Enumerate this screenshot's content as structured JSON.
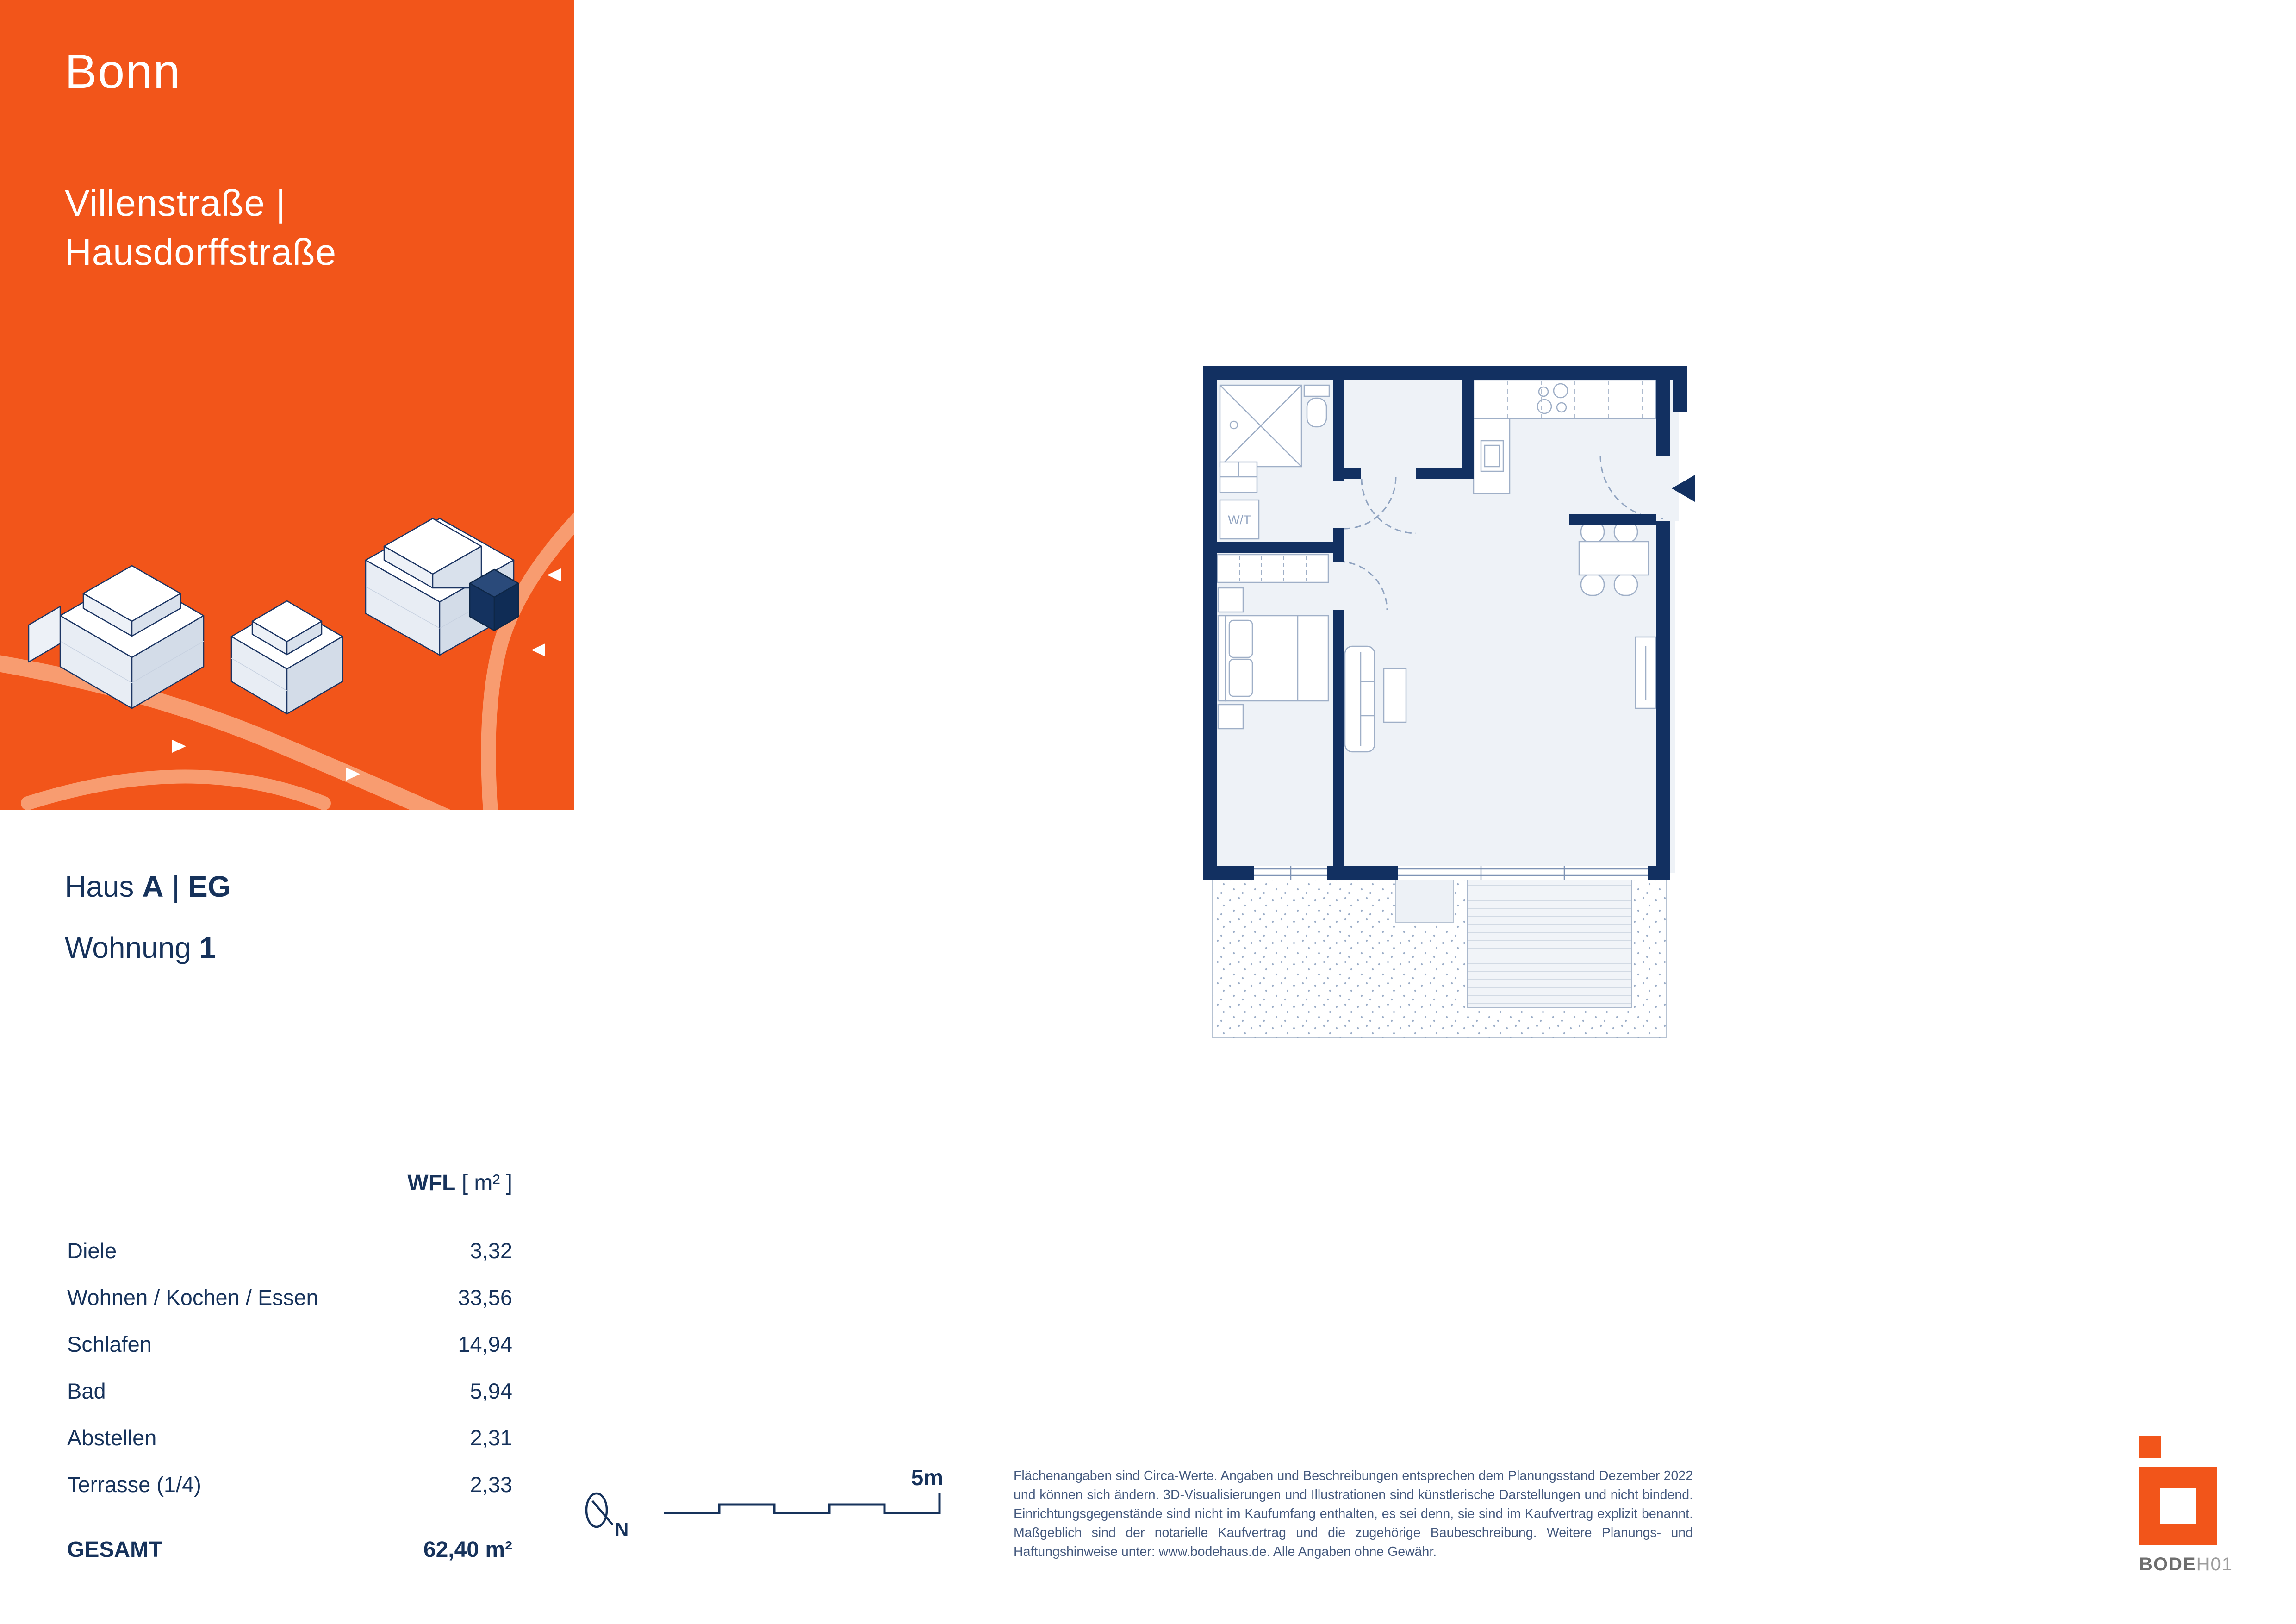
{
  "header": {
    "city": "Bonn",
    "street_line1": "Villenstraße |",
    "street_line2": "Hausdorffstraße"
  },
  "unit": {
    "haus_label": "Haus",
    "haus_value": "A",
    "separator": "|",
    "floor_value": "EG",
    "wohnung_label": "Wohnung",
    "wohnung_value": "1"
  },
  "area_table": {
    "header_bold": "WFL",
    "header_unit": "[ m² ]",
    "rows": [
      {
        "label": "Diele",
        "value": "3,32"
      },
      {
        "label": "Wohnen / Kochen / Essen",
        "value": "33,56"
      },
      {
        "label": "Schlafen",
        "value": "14,94"
      },
      {
        "label": "Bad",
        "value": "5,94"
      },
      {
        "label": "Abstellen",
        "value": "2,31"
      },
      {
        "label": "Terrasse (1/4)",
        "value": "2,33"
      }
    ],
    "total_label": "GESAMT",
    "total_value": "62,40 m²"
  },
  "plan": {
    "wt_label": "W/T"
  },
  "map": {
    "north_label": "N",
    "scale_label": "5m"
  },
  "disclaimer": {
    "text": "Flächenangaben sind Circa-Werte. Angaben und Beschreibungen entsprechen dem Planungsstand Dezember 2022 und können sich ändern. 3D-Visualisierungen und Illustrationen sind künstlerische Darstellungen und nicht bindend. Einrichtungsgegenstände sind nicht im Kaufumfang enthalten, es sei denn, sie sind im Kaufvertrag explizit benannt. Maßgeblich sind der notarielle Kaufvertrag und die zugehörige Baubeschreibung. Weitere Planungs- und Haftungshinweise unter: www.bodehaus.de. Alle Angaben ohne Gewähr."
  },
  "logo": {
    "brand_bold": "BODE",
    "brand_light": "H01"
  },
  "colors": {
    "orange": "#F2551A",
    "orange_road": "#F89C70",
    "navy": "#16325B",
    "wall": "#123061",
    "floor": "#EEF2F7",
    "plan_line": "#9FAFC7"
  }
}
